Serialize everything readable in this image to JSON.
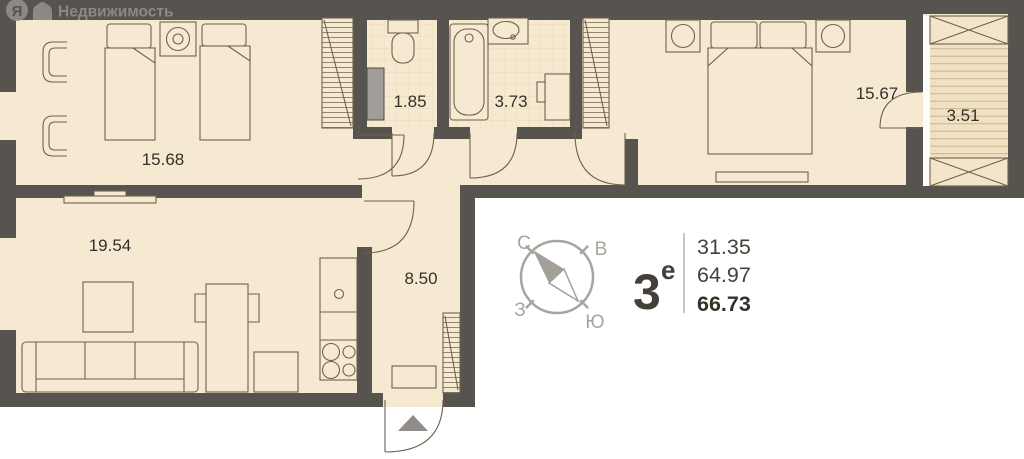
{
  "logo": {
    "initial": "Я",
    "brand": "Недвижимость"
  },
  "plan": {
    "rooms": [
      {
        "area": "15.68"
      },
      {
        "area": "1.85"
      },
      {
        "area": "3.73"
      },
      {
        "area": "15.67"
      },
      {
        "area": "3.51"
      },
      {
        "area": "19.54"
      },
      {
        "area": "8.50"
      }
    ]
  },
  "compass": {
    "n": "С",
    "e": "В",
    "w": "З",
    "s": "Ю"
  },
  "info": {
    "type_number": "3",
    "type_suffix": "е",
    "values": [
      "31.35",
      "64.97",
      "66.73"
    ]
  },
  "colors": {
    "wall": "#57534E",
    "floor": "#F5E9D1",
    "furniture_line": "#70614E",
    "compass_gray": "#A8A49E",
    "label_text": "#35302A"
  }
}
